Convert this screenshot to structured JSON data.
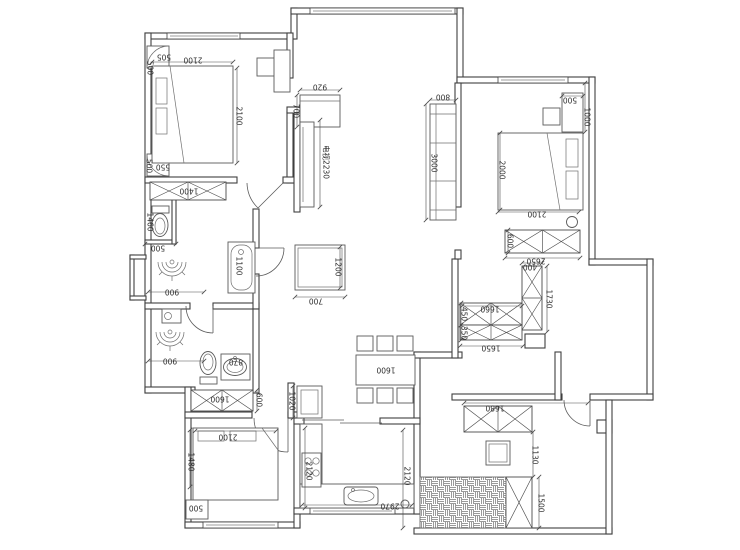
{
  "labels": {
    "bedroom_a": {
      "corner_shelf_top_w": "505",
      "corner_shelf_top_d": "500",
      "bed_width": "2100",
      "bed_length": "2100",
      "corner_shelf_bottom_w": "550",
      "corner_shelf_bottom_d": "500",
      "wardrobe": "1400"
    },
    "bath_1": {
      "wc_nook_depth": "1460",
      "wc_nook_width": "500",
      "room_width": "900",
      "bathtub_length": "1100"
    },
    "bath_2": {
      "room_width": "900",
      "basin_width": "870"
    },
    "hall_wardrobe": {
      "width": "1600",
      "depth": "600"
    },
    "bedroom_c": {
      "bed_width": "2100",
      "bed_depth": "1480",
      "nightstand": "500"
    },
    "foyer": {
      "cabinet_width": "920",
      "cabinet_depth": "700"
    },
    "living": {
      "tv_wall": "电视2230",
      "coffee_table_length": "1200",
      "coffee_table_width": "700",
      "sofa_length": "3000",
      "sofa_depth": "800"
    },
    "dining": {
      "table_length": "1600"
    },
    "kitchen": {
      "fridge_niche": "1020",
      "counter_run_depth": "2120",
      "counter_run_length": "2970"
    },
    "bedroom_b": {
      "nightstand_width": "500",
      "niche_depth": "1000",
      "bed_length": "2000",
      "bed_width": "2100",
      "wardrobe_depth": "600",
      "wardrobe_width": "2650"
    },
    "corridor": {
      "cabinet_depth": "400",
      "cabinet_length": "1730",
      "upper_run": "1660",
      "depth_a": "450",
      "depth_b": "350",
      "lower_run": "1650"
    },
    "laundry": {
      "cabinet_width": "1680",
      "gap": "1130",
      "cabinet_run": "1500",
      "balcony_width": "2120"
    }
  },
  "colors": {
    "background": "#ffffff",
    "wall_line": "#3f3f3f",
    "furniture_line": "#5a5a5a",
    "dimension_text": "#2e2e2e",
    "hatch": "#9a9a9a"
  }
}
